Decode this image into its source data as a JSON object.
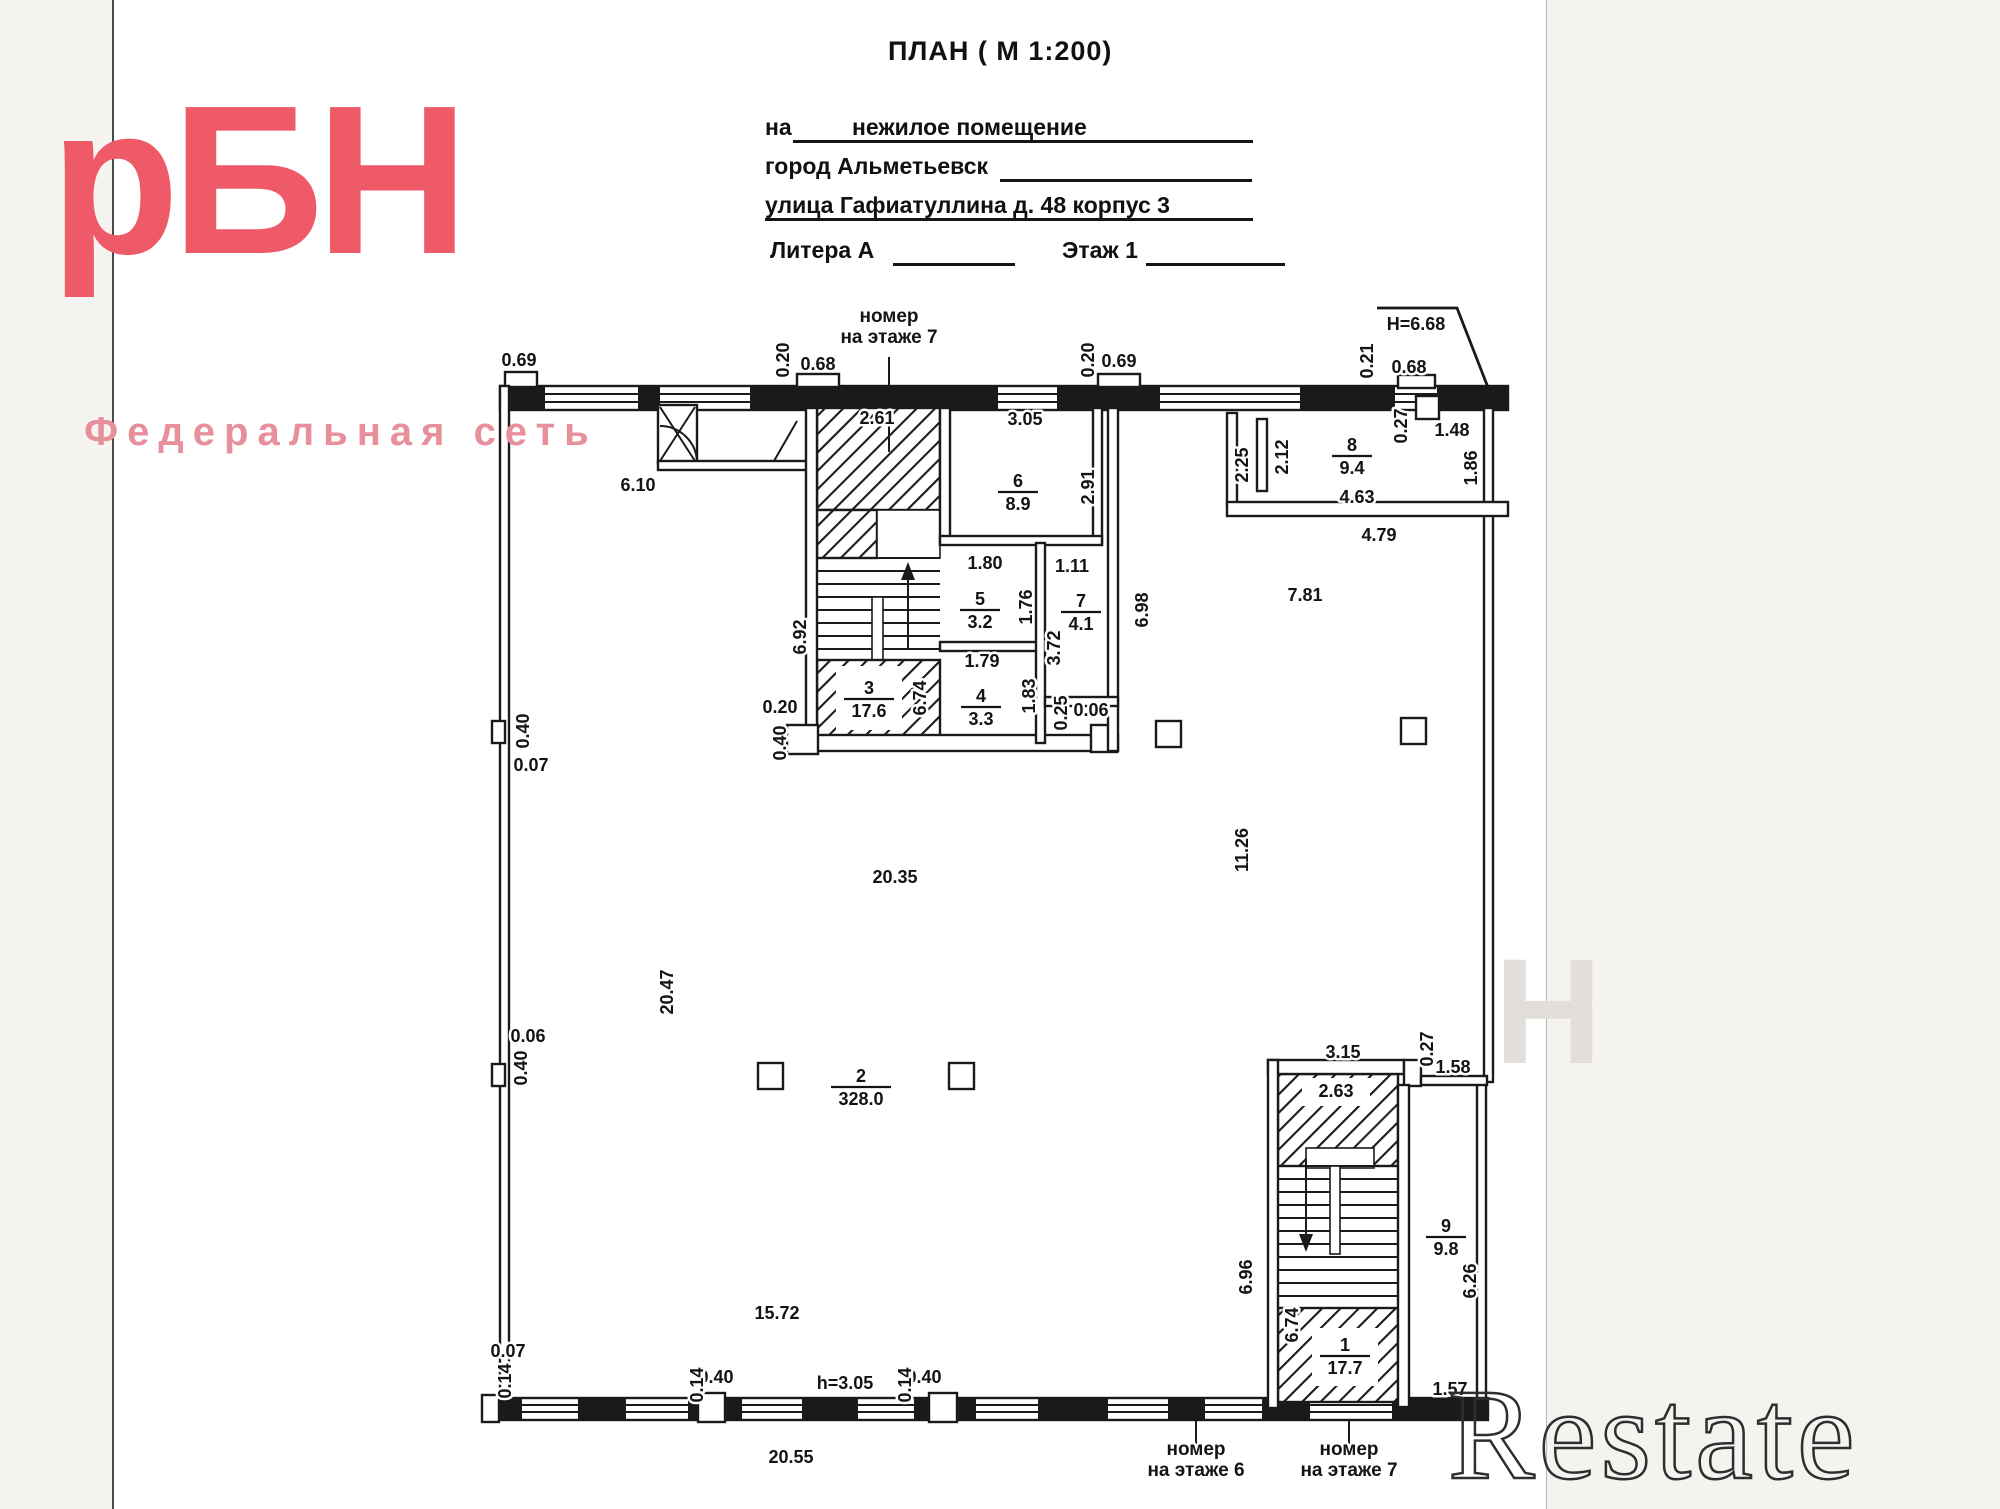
{
  "header": {
    "title": "ПЛАН ( М 1:200)",
    "for_label": "на",
    "for_value": "нежилое помещение",
    "city": "город Альметьевск",
    "street": "улица Гафиатуллина д. 48 корпус 3",
    "litera": "Литера А",
    "floor": "Этаж 1"
  },
  "logo": {
    "text": "рБН",
    "subtitle": "Федеральная сеть",
    "color": "#ef5a68"
  },
  "watermark": {
    "text": "Restate",
    "ghost": "Н"
  },
  "plan": {
    "height_note": "Н=6.68",
    "ceiling_note": "h=3.05",
    "rooms": [
      {
        "num": "1",
        "area": "17.7",
        "x": 1345,
        "y": 1356
      },
      {
        "num": "2",
        "area": "328.0",
        "x": 861,
        "y": 1087
      },
      {
        "num": "3",
        "area": "17.6",
        "x": 869,
        "y": 699
      },
      {
        "num": "4",
        "area": "3.3",
        "x": 981,
        "y": 707
      },
      {
        "num": "5",
        "area": "3.2",
        "x": 980,
        "y": 610
      },
      {
        "num": "6",
        "area": "8.9",
        "x": 1018,
        "y": 492
      },
      {
        "num": "7",
        "area": "4.1",
        "x": 1081,
        "y": 612
      },
      {
        "num": "8",
        "area": "9.4",
        "x": 1352,
        "y": 456
      },
      {
        "num": "9",
        "area": "9.8",
        "x": 1446,
        "y": 1237
      }
    ],
    "dims": [
      {
        "t": "0.69",
        "x": 519,
        "y": 361
      },
      {
        "t": "0.20",
        "x": 784,
        "y": 360,
        "r": 1
      },
      {
        "t": "0.68",
        "x": 818,
        "y": 365
      },
      {
        "t": "0.20",
        "x": 1089,
        "y": 360,
        "r": 1
      },
      {
        "t": "0.69",
        "x": 1119,
        "y": 362
      },
      {
        "t": "0.21",
        "x": 1368,
        "y": 361,
        "r": 1
      },
      {
        "t": "0.68",
        "x": 1409,
        "y": 368
      },
      {
        "t": "Н=6.68",
        "x": 1416,
        "y": 325
      },
      {
        "t": "1.48",
        "x": 1452,
        "y": 431
      },
      {
        "t": "0.27",
        "x": 1402,
        "y": 426,
        "r": 1
      },
      {
        "t": "1.86",
        "x": 1472,
        "y": 468,
        "r": 1
      },
      {
        "t": "2.25",
        "x": 1243,
        "y": 465,
        "r": 1
      },
      {
        "t": "2.12",
        "x": 1283,
        "y": 457,
        "r": 1
      },
      {
        "t": "4.63",
        "x": 1357,
        "y": 498
      },
      {
        "t": "4.79",
        "x": 1379,
        "y": 536
      },
      {
        "t": "6.10",
        "x": 638,
        "y": 486
      },
      {
        "t": "2.61",
        "x": 877,
        "y": 419
      },
      {
        "t": "3.05",
        "x": 1025,
        "y": 420
      },
      {
        "t": "2.91",
        "x": 1089,
        "y": 487,
        "r": 1
      },
      {
        "t": "6.92",
        "x": 801,
        "y": 637,
        "r": 1
      },
      {
        "t": "1.80",
        "x": 985,
        "y": 564
      },
      {
        "t": "1.76",
        "x": 1027,
        "y": 607,
        "r": 1
      },
      {
        "t": "1.11",
        "x": 1072,
        "y": 567
      },
      {
        "t": "3.72",
        "x": 1055,
        "y": 648,
        "r": 1
      },
      {
        "t": "1.79",
        "x": 982,
        "y": 662
      },
      {
        "t": "1.83",
        "x": 1030,
        "y": 696,
        "r": 1
      },
      {
        "t": "6.74",
        "x": 921,
        "y": 698,
        "r": 1
      },
      {
        "t": "0.25",
        "x": 1062,
        "y": 713,
        "r": 1
      },
      {
        "t": "0.06",
        "x": 1091,
        "y": 711
      },
      {
        "t": "6.98",
        "x": 1143,
        "y": 610,
        "r": 1
      },
      {
        "t": "7.81",
        "x": 1305,
        "y": 596
      },
      {
        "t": "0.20",
        "x": 780,
        "y": 708
      },
      {
        "t": "0.40",
        "x": 781,
        "y": 743,
        "r": 1
      },
      {
        "t": "0.40",
        "x": 524,
        "y": 731,
        "r": 1
      },
      {
        "t": "0.07",
        "x": 531,
        "y": 766
      },
      {
        "t": "20.35",
        "x": 895,
        "y": 878
      },
      {
        "t": "11.26",
        "x": 1243,
        "y": 850,
        "r": 1
      },
      {
        "t": "20.47",
        "x": 668,
        "y": 992,
        "r": 1
      },
      {
        "t": "0.06",
        "x": 528,
        "y": 1037
      },
      {
        "t": "0.40",
        "x": 522,
        "y": 1068,
        "r": 1
      },
      {
        "t": "3.15",
        "x": 1343,
        "y": 1053
      },
      {
        "t": "0.27",
        "x": 1428,
        "y": 1049,
        "r": 1
      },
      {
        "t": "1.58",
        "x": 1453,
        "y": 1068
      },
      {
        "t": "2.63",
        "x": 1336,
        "y": 1092
      },
      {
        "t": "6.96",
        "x": 1247,
        "y": 1277,
        "r": 1
      },
      {
        "t": "6.26",
        "x": 1471,
        "y": 1281,
        "r": 1
      },
      {
        "t": "6.74",
        "x": 1293,
        "y": 1325,
        "r": 1
      },
      {
        "t": "1.57",
        "x": 1450,
        "y": 1390
      },
      {
        "t": "15.72",
        "x": 777,
        "y": 1314
      },
      {
        "t": "0.07",
        "x": 508,
        "y": 1352
      },
      {
        "t": "0.14",
        "x": 506,
        "y": 1381,
        "r": 1
      },
      {
        "t": "0.40",
        "x": 716,
        "y": 1378
      },
      {
        "t": "0.14",
        "x": 698,
        "y": 1385,
        "r": 1
      },
      {
        "t": "h=3.05",
        "x": 845,
        "y": 1384
      },
      {
        "t": "0.40",
        "x": 924,
        "y": 1378
      },
      {
        "t": "0.14",
        "x": 906,
        "y": 1385,
        "r": 1
      },
      {
        "t": "20.55",
        "x": 791,
        "y": 1458
      }
    ],
    "notes": [
      {
        "l1": "номер",
        "l2": "на этаже 7",
        "x": 889,
        "y": 327
      },
      {
        "l1": "номер",
        "l2": "на этаже 6",
        "x": 1196,
        "y": 1460
      },
      {
        "l1": "номер",
        "l2": "на этаже 7",
        "x": 1349,
        "y": 1460
      }
    ]
  }
}
